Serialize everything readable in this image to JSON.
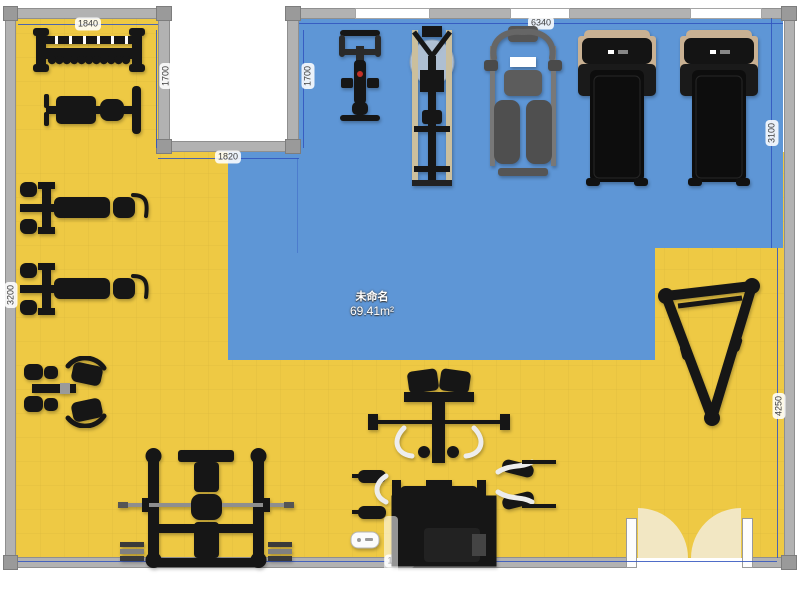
{
  "app": {
    "type": "gym-floor-plan-editor"
  },
  "room": {
    "label": "未命名",
    "area": "69.41m²"
  },
  "dims": {
    "alcove_width": "1840",
    "alcove_height_left": "1700",
    "alcove_height_right": "1700",
    "notch_width": "1820",
    "top_right_width": "6340",
    "right_upper": "3100",
    "right_lower": "4250",
    "left_wall": "3200",
    "total_width": "10000"
  },
  "colors": {
    "floor_yellow": "#eec944",
    "room_blue": "#5e96d6",
    "wall_gray": "#b2b2b2",
    "dimension_line": "#3054be",
    "door_swing": "#f2e7c3",
    "equipment": "#161616"
  },
  "equipment": [
    "dumbbell-rack",
    "flat-bench",
    "bench-machine",
    "bench-machine",
    "leg-curl-machine",
    "bench-press-station",
    "multi-station-trainer",
    "a-frame-rack",
    "spin-bike",
    "rowing-machine",
    "recumbent-bike",
    "treadmill",
    "treadmill",
    "floor-scale"
  ]
}
